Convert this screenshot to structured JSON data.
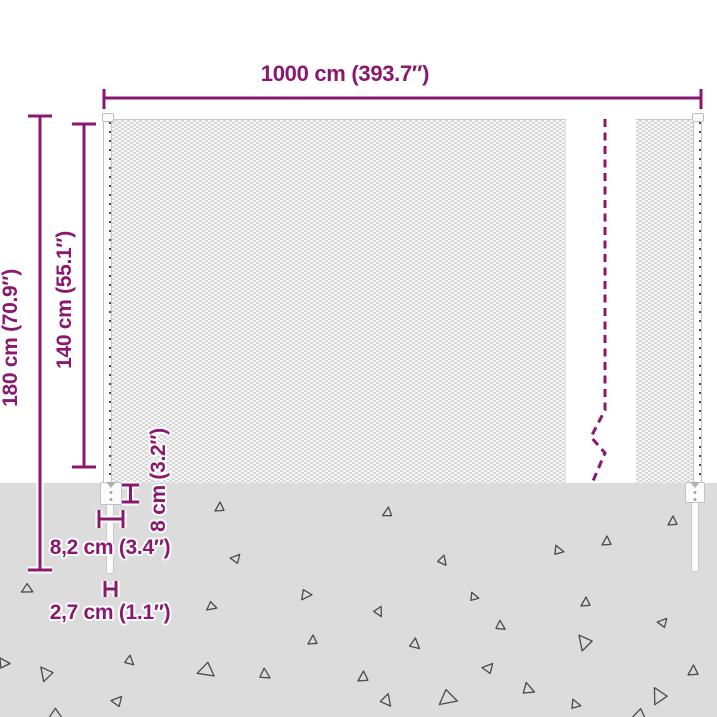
{
  "colors": {
    "accent": "#8a186e",
    "ground": "#dcdcdc",
    "mesh_dark": "#d7d7d7",
    "mesh_light": "#f6f6f6",
    "triangle_stroke": "#4a4a4a",
    "post_border": "#c3c3c3",
    "background": "#ffffff"
  },
  "labels": {
    "total_width": "1000 cm (393.7″)",
    "total_height": "180 cm (70.9″)",
    "mesh_height": "140 cm (55.1″)",
    "buried_depth": "8 cm (3.2″)",
    "anchor_width": "8,2 cm (3.4″)",
    "stake_width": "2,7 cm (1.1″)"
  },
  "ground": {
    "triangles": [
      {
        "x": 215,
        "y": 502,
        "s": 9,
        "r": 0
      },
      {
        "x": 383,
        "y": 507,
        "s": 9,
        "r": 5
      },
      {
        "x": 232,
        "y": 553,
        "s": 9,
        "r": 40
      },
      {
        "x": 439,
        "y": 557,
        "s": 9,
        "r": 140
      },
      {
        "x": 300,
        "y": 591,
        "s": 10,
        "r": 215
      },
      {
        "x": 206,
        "y": 603,
        "s": 9,
        "r": 230
      },
      {
        "x": 375,
        "y": 608,
        "s": 9,
        "r": 150
      },
      {
        "x": 471,
        "y": 593,
        "s": 8,
        "r": 100
      },
      {
        "x": 497,
        "y": 622,
        "s": 9,
        "r": 120
      },
      {
        "x": 308,
        "y": 635,
        "s": 9,
        "r": 0
      },
      {
        "x": 411,
        "y": 640,
        "s": 10,
        "r": 130
      },
      {
        "x": 197,
        "y": 664,
        "s": 15,
        "r": 250
      },
      {
        "x": 261,
        "y": 670,
        "s": 10,
        "r": 120
      },
      {
        "x": 358,
        "y": 671,
        "s": 10,
        "r": 0
      },
      {
        "x": 484,
        "y": 662,
        "s": 10,
        "r": 40
      },
      {
        "x": 382,
        "y": 696,
        "s": 11,
        "r": 140
      },
      {
        "x": 438,
        "y": 692,
        "s": 16,
        "r": 230
      },
      {
        "x": 524,
        "y": 684,
        "s": 11,
        "r": 110
      },
      {
        "x": 668,
        "y": 516,
        "s": 9,
        "r": 0
      },
      {
        "x": 602,
        "y": 536,
        "s": 9,
        "r": 0
      },
      {
        "x": 555,
        "y": 546,
        "s": 9,
        "r": 100
      },
      {
        "x": 581,
        "y": 597,
        "s": 9,
        "r": 0
      },
      {
        "x": 659,
        "y": 617,
        "s": 9,
        "r": 40
      },
      {
        "x": 576,
        "y": 634,
        "s": 14,
        "r": 320
      },
      {
        "x": 688,
        "y": 665,
        "s": 10,
        "r": 0
      },
      {
        "x": 650,
        "y": 687,
        "s": 15,
        "r": 330
      },
      {
        "x": 572,
        "y": 700,
        "s": 9,
        "r": 100
      },
      {
        "x": 632,
        "y": 710,
        "s": 12,
        "r": 250
      },
      {
        "x": 21,
        "y": 585,
        "s": 10,
        "r": 240
      },
      {
        "x": 126,
        "y": 657,
        "s": 9,
        "r": 130
      },
      {
        "x": 38,
        "y": 666,
        "s": 13,
        "r": 320
      },
      {
        "x": 113,
        "y": 695,
        "s": 10,
        "r": 40
      },
      {
        "x": 48,
        "y": 710,
        "s": 12,
        "r": 240
      },
      {
        "x": 0,
        "y": 658,
        "s": 10,
        "r": 90
      }
    ]
  }
}
